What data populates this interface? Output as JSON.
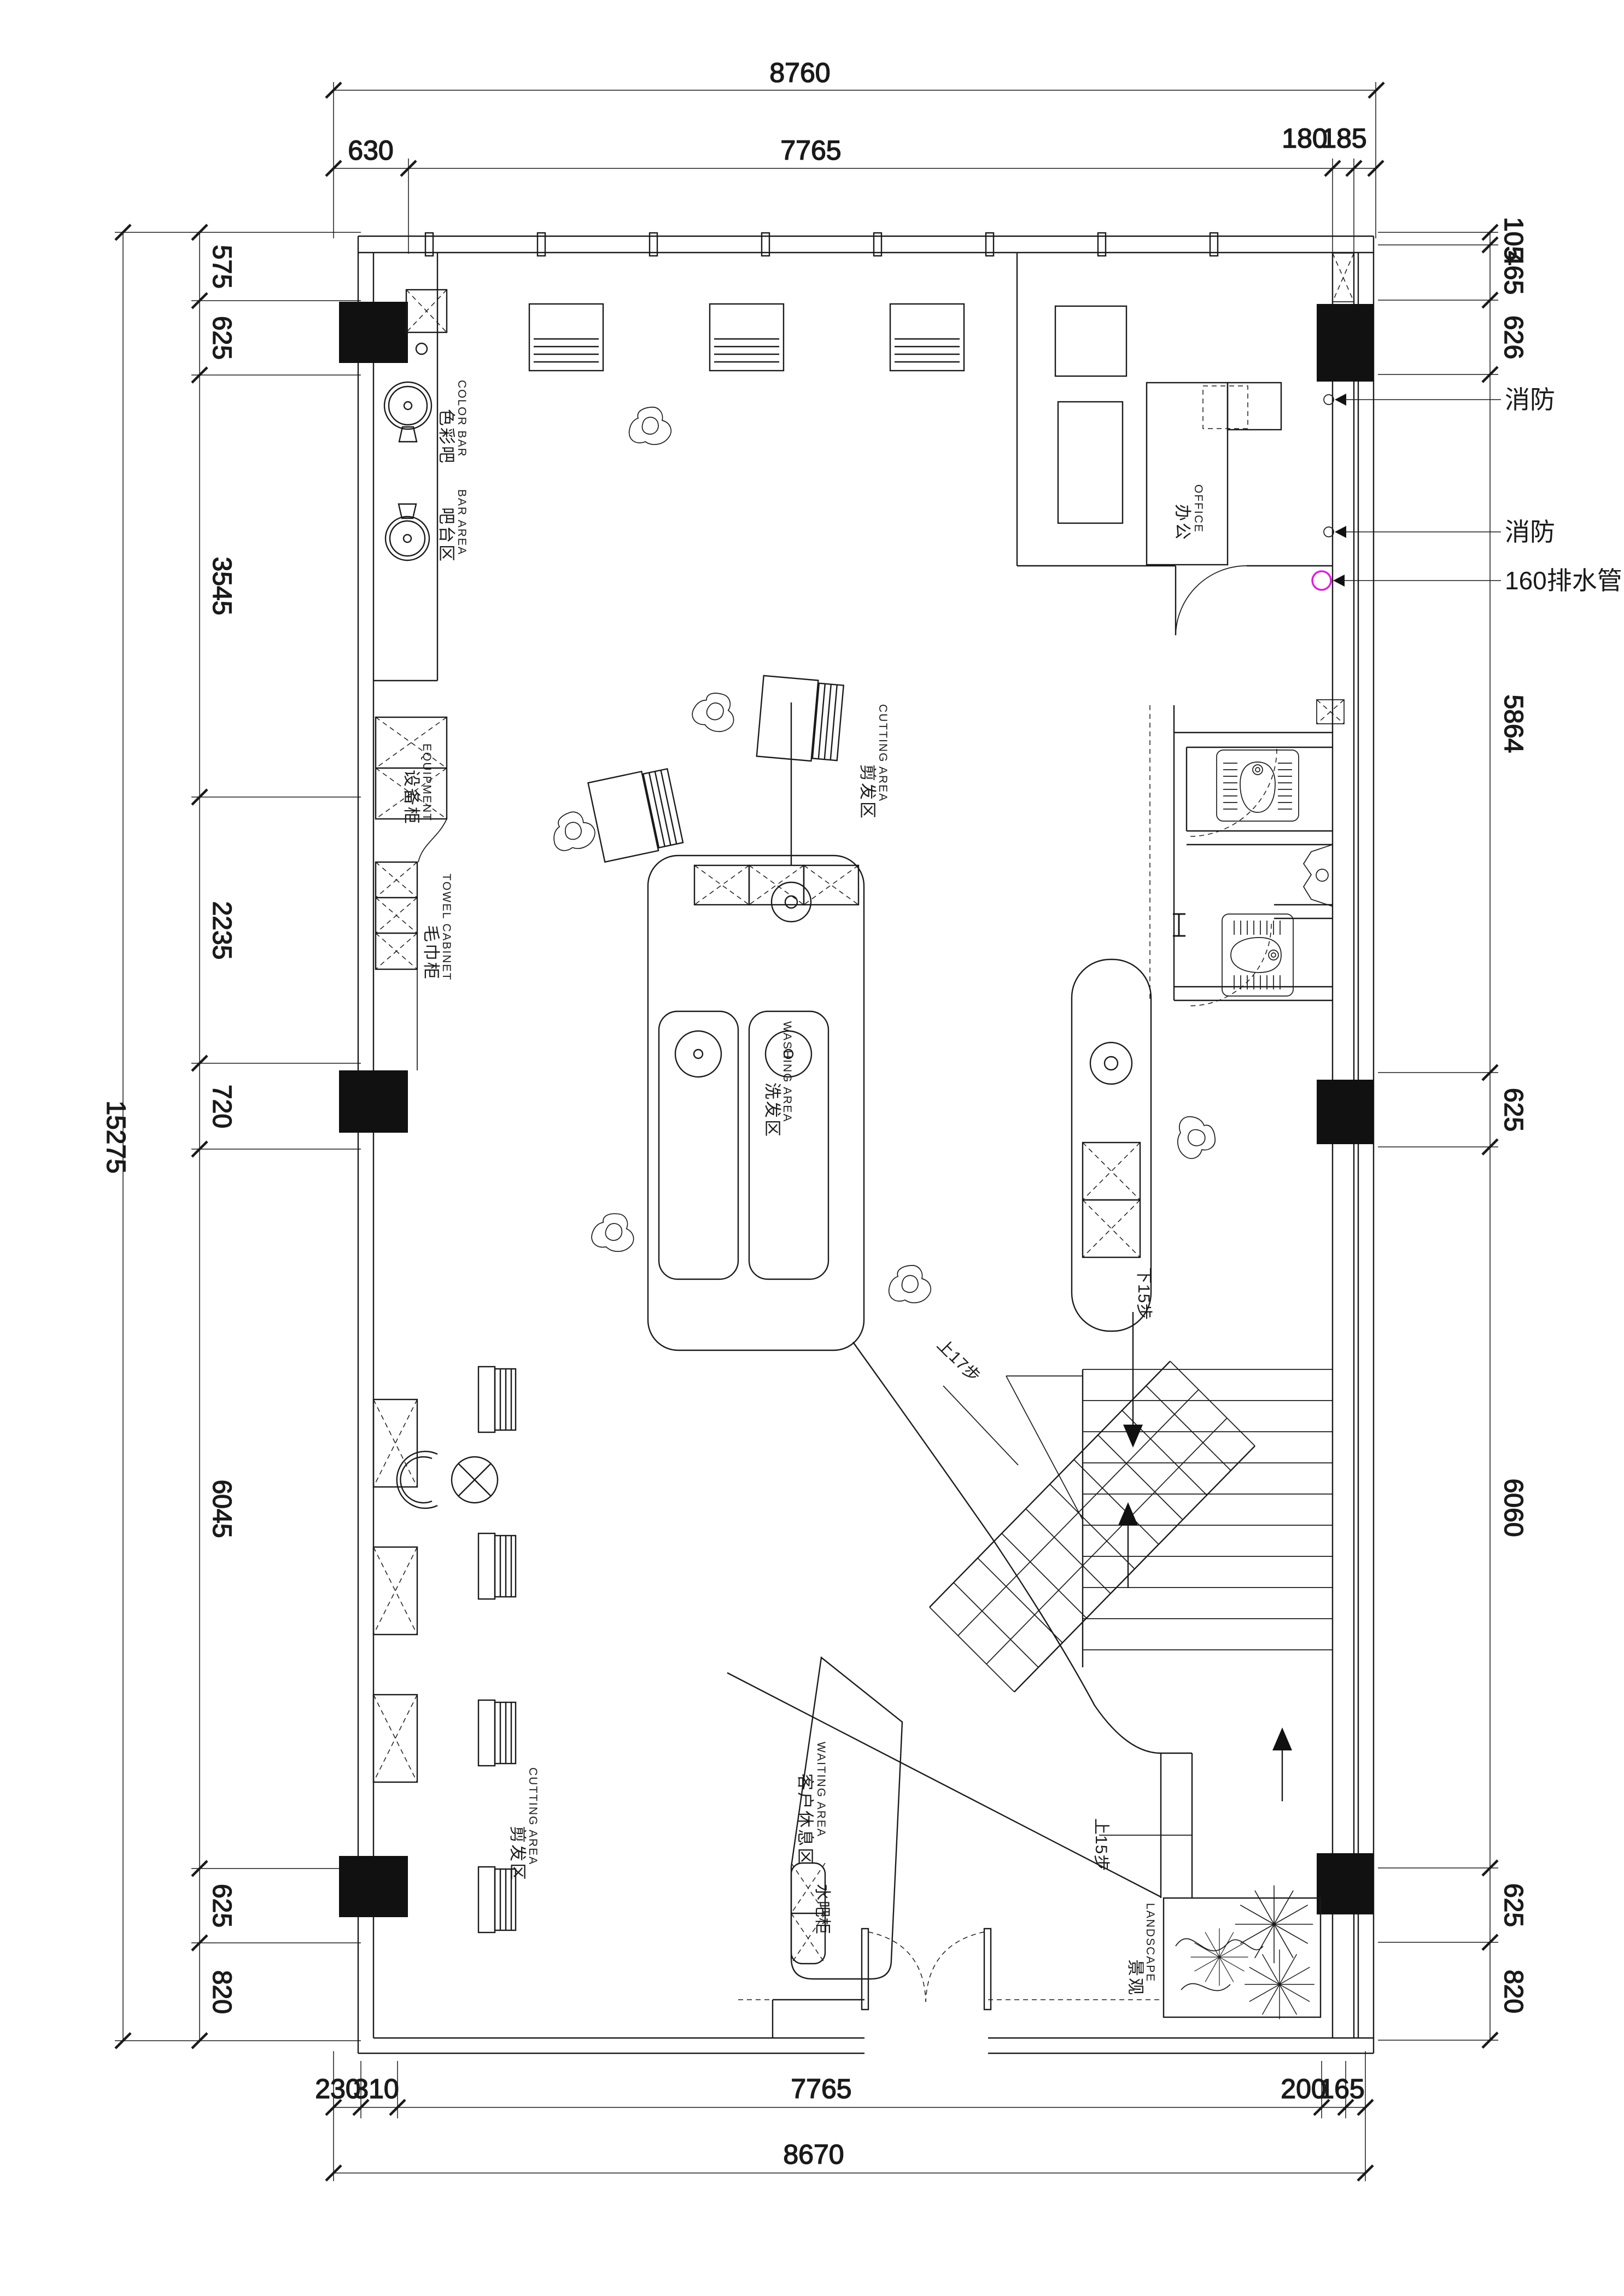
{
  "dimensions": {
    "top": {
      "overall": "8760",
      "segments": [
        "630",
        "7765",
        "180",
        "185"
      ]
    },
    "bottom": {
      "overall": "8670",
      "segments": [
        "230",
        "310",
        "7765",
        "200",
        "165"
      ]
    },
    "left": {
      "overall": "15275",
      "segments": [
        "575",
        "625",
        "3545",
        "2235",
        "720",
        "6045",
        "625",
        "820"
      ]
    },
    "right": {
      "segments": [
        "105",
        "465",
        "626",
        "5864",
        "625",
        "6060",
        "625",
        "820"
      ]
    }
  },
  "annotations": {
    "fire_hydrant_1": "消防",
    "fire_hydrant_2": "消防",
    "drain_pipe": "160排水管"
  },
  "stair_labels": {
    "up_17": "上17步",
    "down_15": "下15步",
    "up_15": "上15步"
  },
  "rooms": {
    "color_bar": {
      "en": "COLOR BAR",
      "cn": "色彩吧"
    },
    "bar_area": {
      "en": "BAR AREA",
      "cn": "吧台区"
    },
    "equipment_cabinet": {
      "en": "EQUIPMENT",
      "cn": "设备柜"
    },
    "towel_cabinet": {
      "en": "TOWEL CABINET",
      "cn": "毛巾柜"
    },
    "cutting_area_center": {
      "en": "CUTTING AREA",
      "cn": "剪发区"
    },
    "washing_area": {
      "en": "WASHING AREA",
      "cn": "洗发区"
    },
    "office": {
      "en": "OFFICE",
      "cn": "办公"
    },
    "cutting_area_south": {
      "en": "CUTTING AREA",
      "cn": "剪发区"
    },
    "waiting_area": {
      "en": "WAITING AREA",
      "cn": "客户休息区"
    },
    "water_bar_cabinet": {
      "cn": "水吧柜"
    },
    "landscape": {
      "en": "LANDSCAPE",
      "cn": "景观"
    }
  },
  "colors": {
    "line": "#1a1a1a",
    "drain": "#e020e0",
    "background": "#ffffff"
  }
}
